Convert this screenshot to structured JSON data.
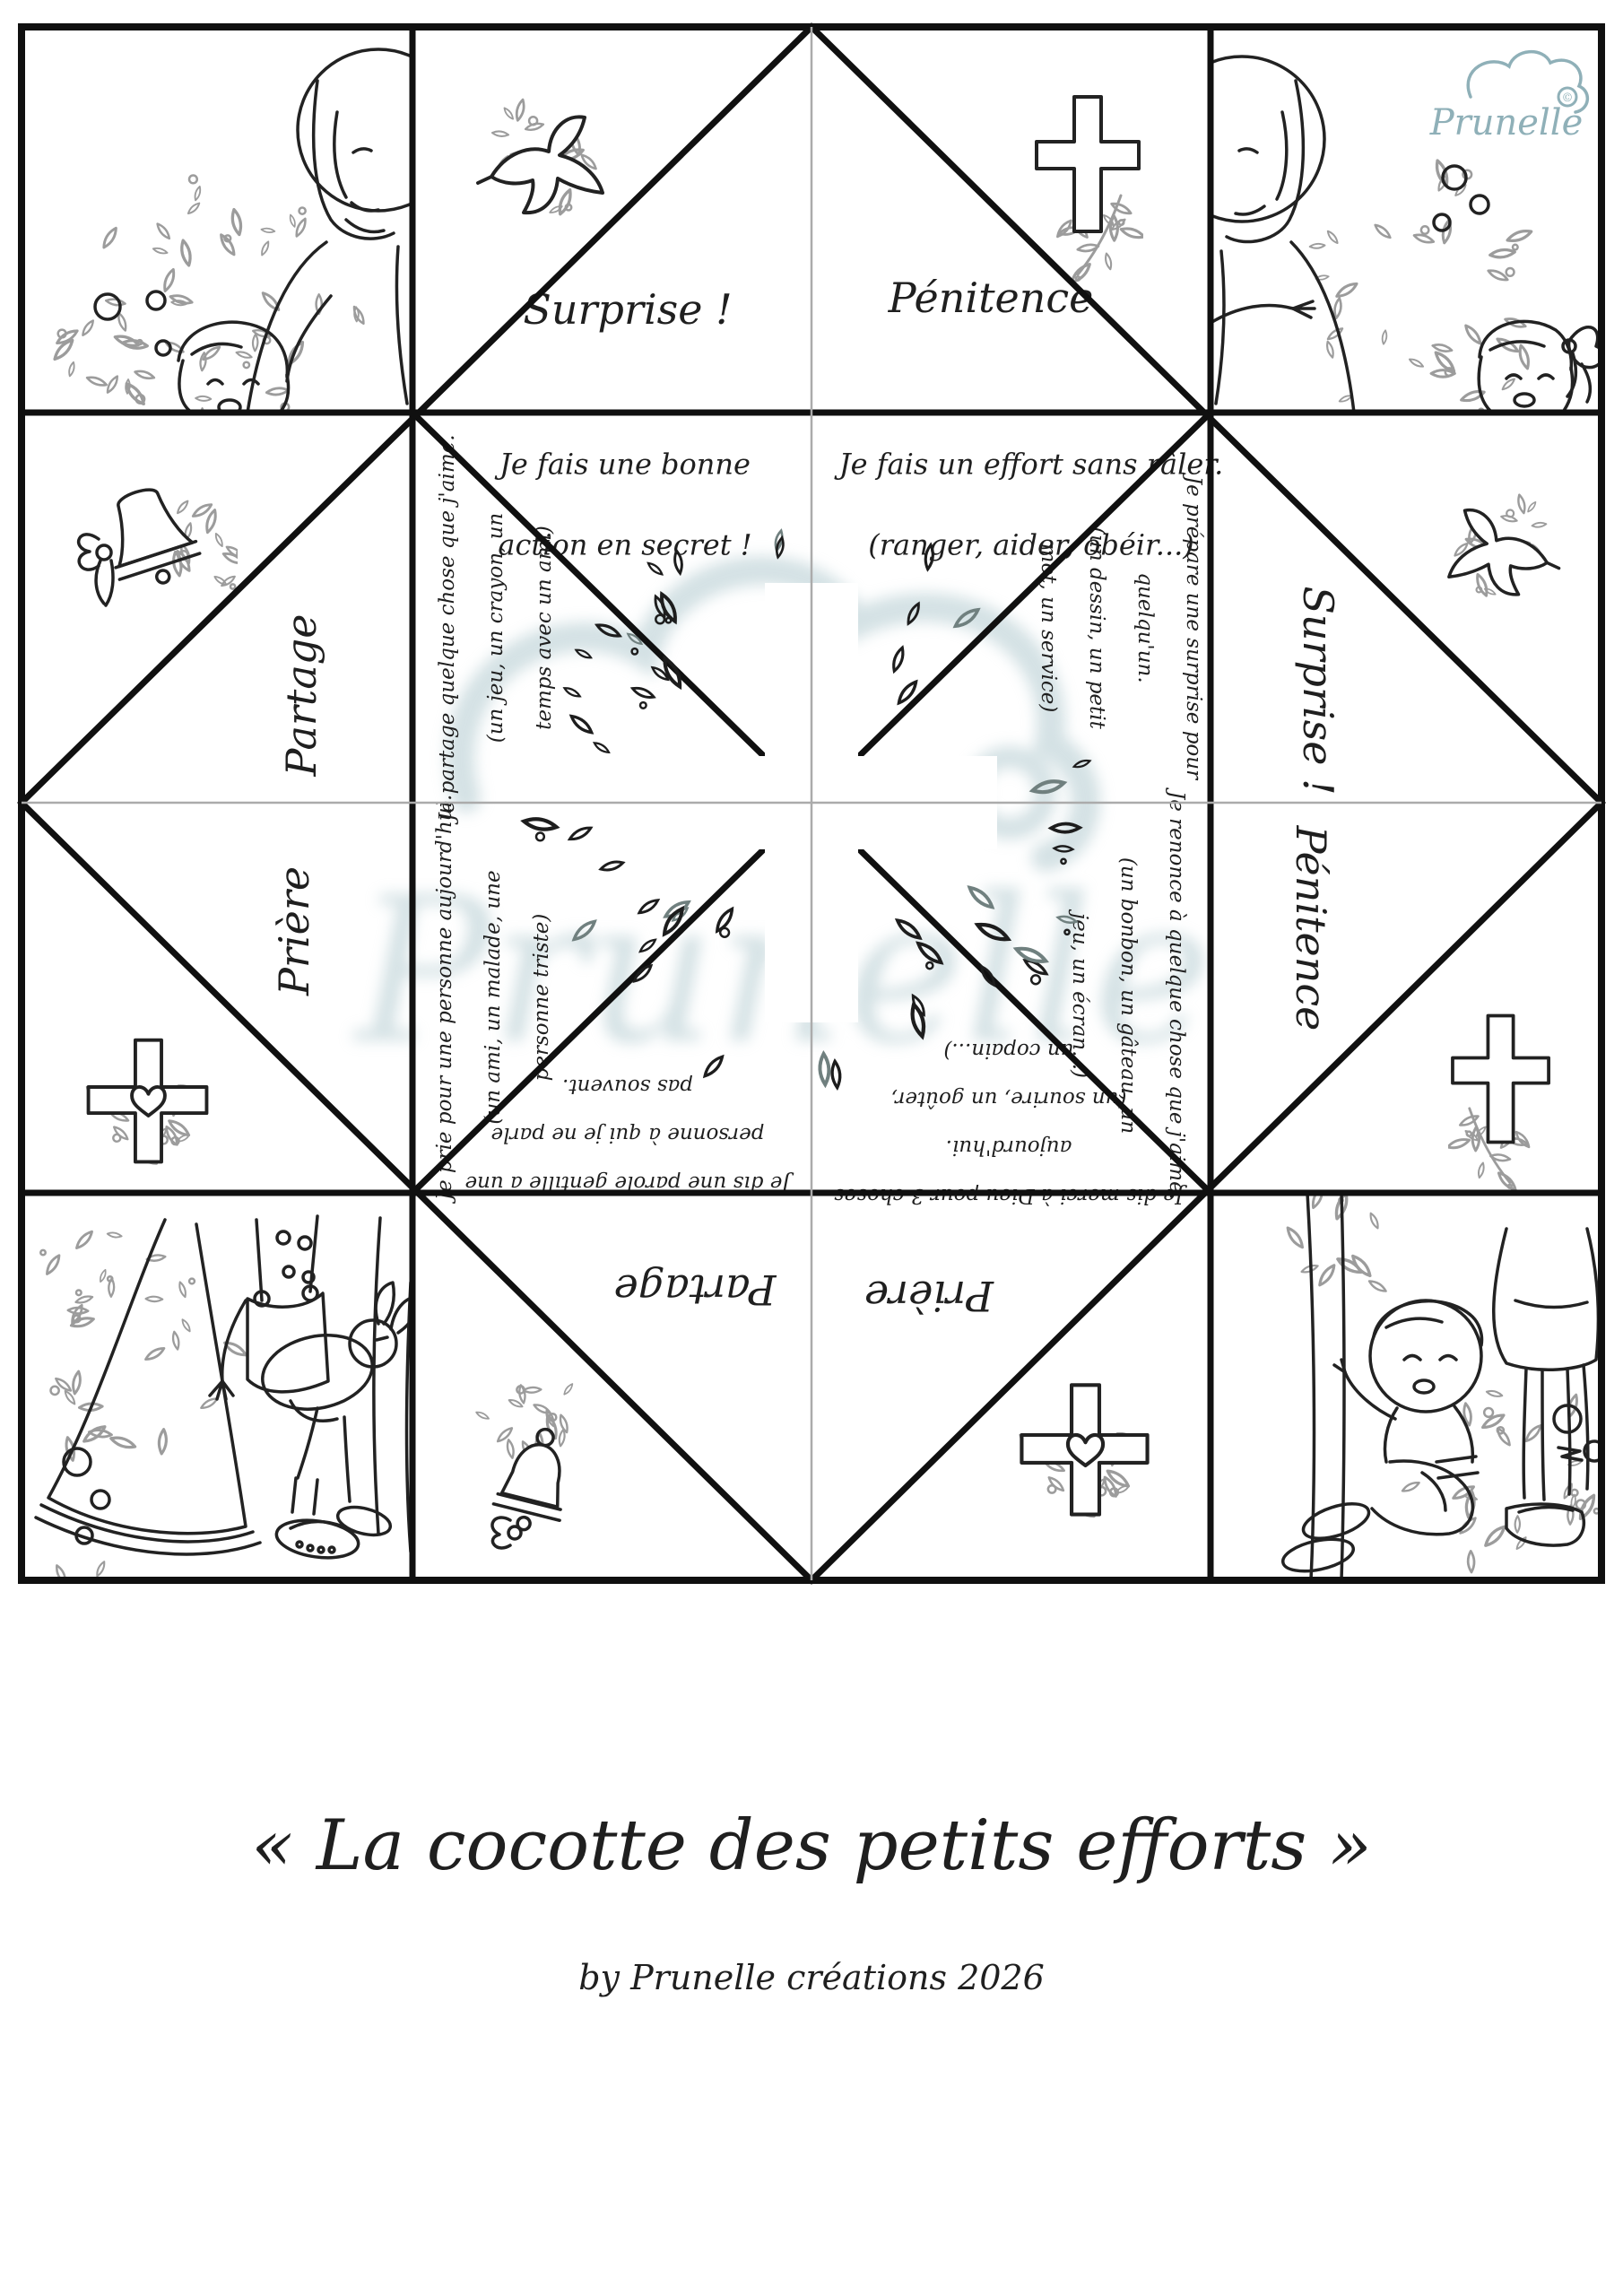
{
  "page": {
    "title": "« La cocotte des petits efforts »",
    "byline": "by Prunelle créations 2026",
    "brand": "Prunelle",
    "brand_mark": "©"
  },
  "cocotte": {
    "flaps": {
      "surprise_top": "Surprise !",
      "penitence_top": "Pénitence",
      "partage_left": "Partage",
      "priere_left": "Prière",
      "surprise_right": "Surprise !",
      "penitence_right": "Pénitence",
      "partage_bottom": "Partage",
      "priere_bottom": "Prière"
    },
    "actions": {
      "bonne_action": [
        "Je fais une bonne",
        "action en secret !"
      ],
      "effort": [
        "Je fais un effort sans râler.",
        "(ranger, aider, obéir...)"
      ],
      "partage": [
        "Je partage quelque chose que j'aime.",
        "(un jeu, un crayon, un",
        "temps avec un ami)"
      ],
      "priere": [
        "Je prie pour une personne aujourd'hui.",
        "(un ami, un malade, une",
        "personne triste)"
      ],
      "surprise": [
        "Je prépare une surprise pour",
        "quelqu'un.",
        "(un dessin, un petit",
        "mot, un service)"
      ],
      "penitence": [
        "Je renonce à quelque chose que j'aime.",
        "(un bonbon, un gâteau, un",
        "jeu, un écran...)"
      ],
      "parole": [
        "Je dis une parole gentille à une",
        "personne à qui je ne parle",
        "pas souvent."
      ],
      "merci": [
        "Je dis merci à Dieu pour 3 choses",
        "aujourd'hui.",
        "(un sourire, un goûter,",
        "un copain...)"
      ]
    }
  },
  "icons": {
    "top_left_cell": "dove-olive-branch-icon",
    "top_right_cell": "cross-olive-branch-icon",
    "left_upper_cell": "bell-ribbon-icon",
    "left_lower_cell": "cross-heart-foliage-icon",
    "right_upper_cell": "dove-foliage-icon",
    "right_lower_cell": "cross-olive-branch-icon",
    "bottom_left_cell": "handbell-ribbon-foliage-icon",
    "bottom_right_cell": "cross-heart-foliage-icon",
    "center": "foliage-cross-wreath",
    "corner_illustrations": [
      "jesus-with-boy",
      "jesus-with-girl",
      "child-with-lamb-on-bell",
      "children-sitting"
    ]
  },
  "colors": {
    "line_art": "#222222",
    "fold_line": "#101010",
    "thin_fold_line": "#ababab",
    "foliage": "#9c9c9c",
    "brand": "#8fb0b8",
    "watermark": "#a9c4ca"
  }
}
